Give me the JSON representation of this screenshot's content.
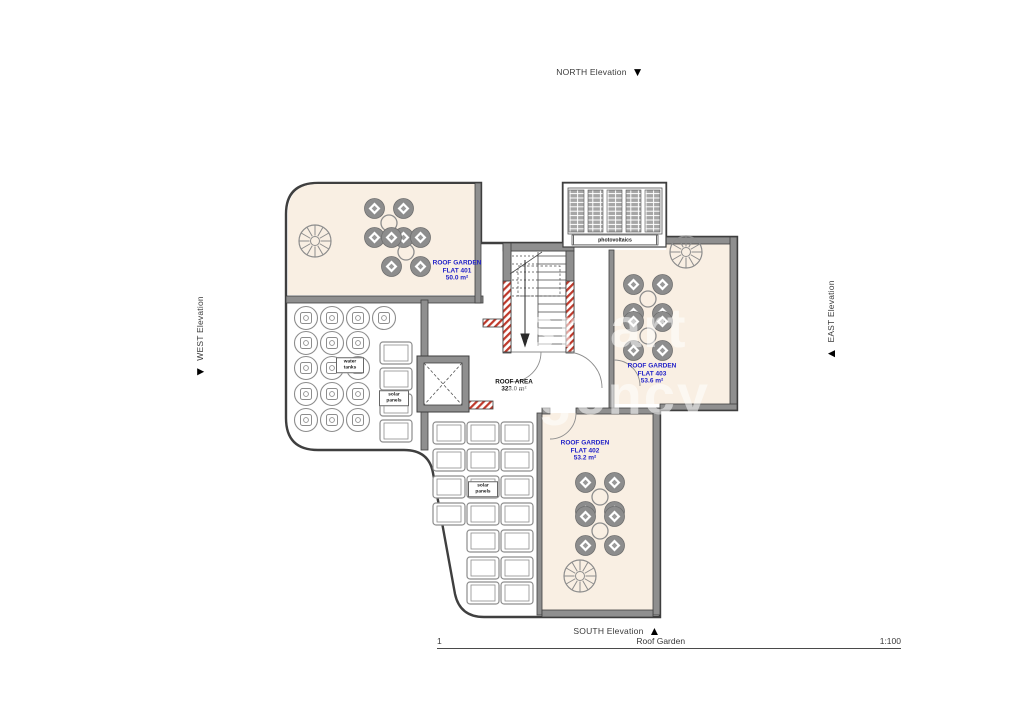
{
  "title_block": {
    "number": "1",
    "title": "Roof Garden",
    "scale": "1:100"
  },
  "elevations": {
    "north": "NORTH Elevation",
    "south": "SOUTH Elevation",
    "west": "WEST Elevation",
    "east": "EAST Elevation"
  },
  "areas": {
    "flat401": {
      "lines": [
        "ROOF GARDEN",
        "FLAT 401",
        "50.0 m²"
      ]
    },
    "flat403": {
      "lines": [
        "ROOF GARDEN",
        "FLAT 403",
        "53.6 m²"
      ]
    },
    "flat402": {
      "lines": [
        "ROOF GARDEN",
        "FLAT 402",
        "53.2 m²"
      ]
    },
    "roof": {
      "lines": [
        "ROOF AREA",
        "323.0 m²"
      ]
    }
  },
  "equipment": {
    "water_tanks": "water tanks",
    "solar_panels_left": "solar panels",
    "solar_panels_bottom": "solar panels",
    "photovoltaics": "photovoltaics"
  },
  "markers": {
    "down_triangle": "▼",
    "up_triangle": "▲"
  },
  "watermark": {
    "line1": "smart",
    "line2": "agency"
  },
  "colors": {
    "roof_garden_fill": "#f9efe3",
    "wall_gray": "#8f8f8f",
    "outline": "#3f3f3f",
    "label_blue": "#2121c8",
    "hatch_red": "#c0392b"
  }
}
